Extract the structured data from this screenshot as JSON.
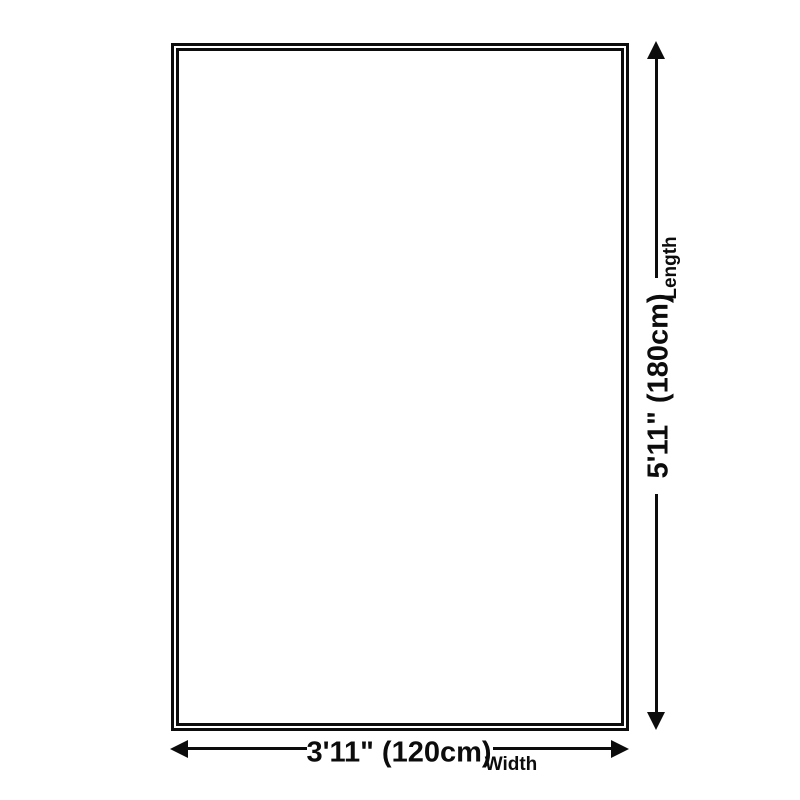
{
  "diagram": {
    "title": "product-size-diagram",
    "dimensions": {
      "length": {
        "value": "5'11\" (180cm)",
        "label": "Length"
      },
      "width": {
        "value": "3'11\" (120cm)",
        "label": "Width"
      }
    }
  },
  "colors": {
    "line-color": "#0c0c0c",
    "bg-color": "#ffffff"
  }
}
